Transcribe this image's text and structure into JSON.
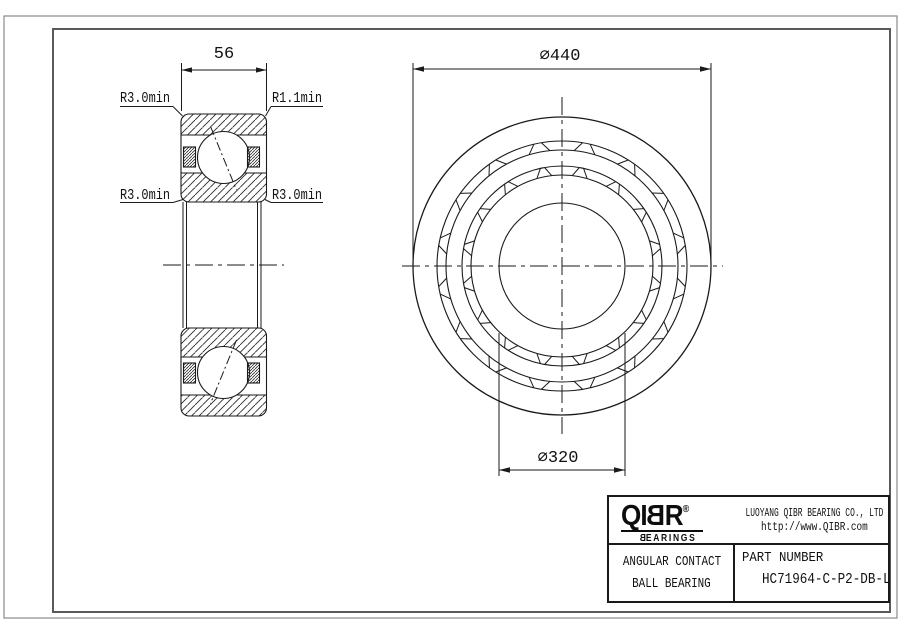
{
  "drawing": {
    "side_view": {
      "width_dim": "56",
      "fillet_top_left": "R3.0min",
      "fillet_top_right": "R1.1min",
      "fillet_bottom_left": "R3.0min",
      "fillet_bottom_right": "R3.0min"
    },
    "front_view": {
      "outer_diameter_dim": "⌀440",
      "bore_diameter_dim": "⌀320"
    }
  },
  "title_block": {
    "logo": {
      "pre": "QI",
      "flipped_b": "B",
      "post": "R",
      "registered": "®",
      "sub_flipped_b": "B",
      "sub_rest": "EARINGS"
    },
    "company_name": "LUOYANG QIBR BEARING CO., LTD",
    "company_url": "http://www.QIBR.com",
    "product_type_line1": "ANGULAR CONTACT",
    "product_type_line2": "BALL BEARING",
    "part_number_label": "PART NUMBER",
    "part_number": "HC71964-C-P2-DB-L"
  },
  "colors": {
    "line": "#1a1a1a",
    "frame_outer": "#8a8a8a",
    "frame_inner": "#5a5a5a"
  }
}
